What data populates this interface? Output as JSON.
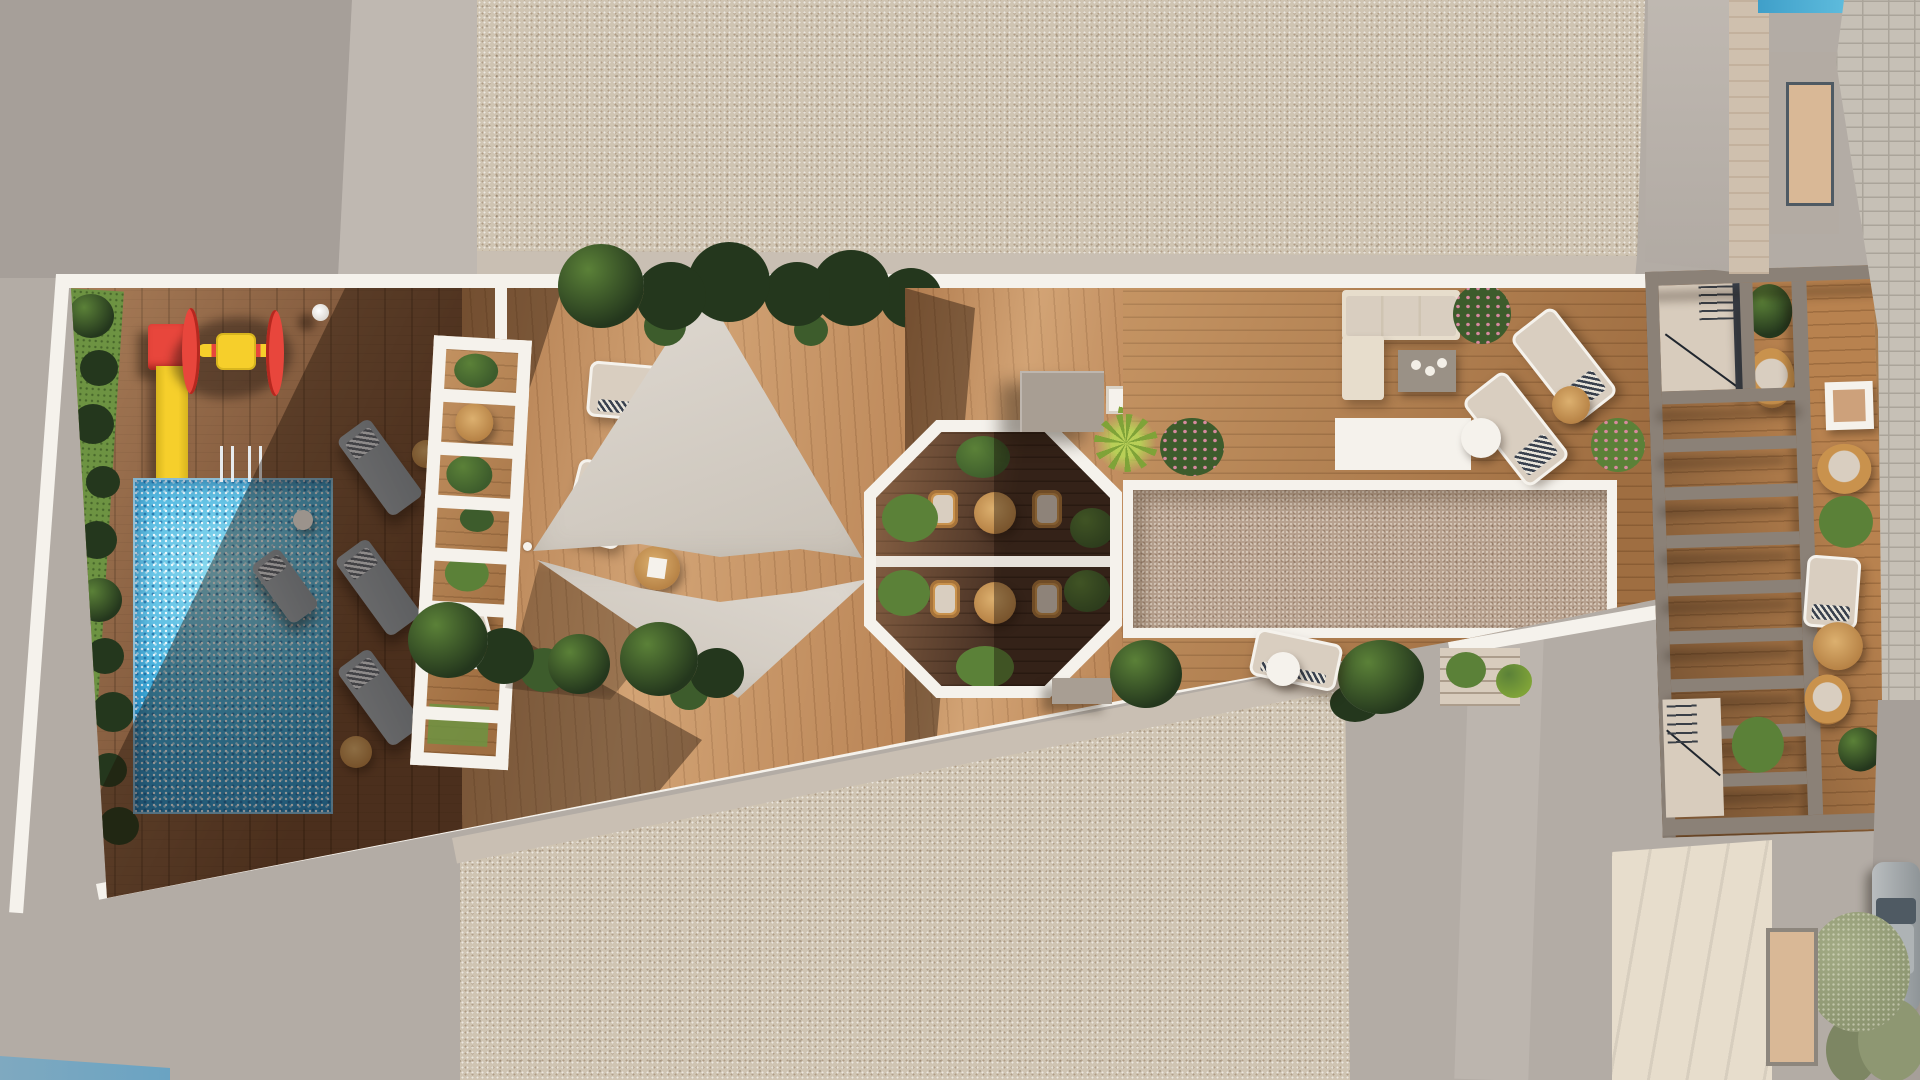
{
  "scene": {
    "type": "aerial architectural 3D rendering, top-down view",
    "description": "Rooftop terrace of a residential building seen from directly above, flanked by speckled concrete roof slabs, with a street and a parked car at the far right",
    "areas": {
      "pool": {
        "label": "Swimming pool with sparkling blue water and two chrome ladders"
      },
      "playground": {
        "label": "Children's playground: red tower with yellow slide into the pool and a red-yellow spinner toy"
      },
      "hedge": {
        "label": "Green hedge strip with dark shrubs along the left terrace edge"
      },
      "sun_deck_left": {
        "label": "Shaded timber pool deck with three grey sun loungers and side tables"
      },
      "white_canopy": {
        "label": "White slatted canopy walk (ladder-like pergola) with planters, a rattan table and a lounger beneath"
      },
      "sail_deck": {
        "label": "Sunlit timber deck with two triangular shade sails, two cream loungers and round serving tables"
      },
      "shade_sails": {
        "label": "Two light-grey triangular shade sails stretched between poles and tie points"
      },
      "planting_rows": {
        "label": "Rows of dark tropical foliage along the deck borders"
      },
      "octagon": {
        "label": "Octagonal sunken dining nook with four rattan chairs, two round tables and boxwood bushes"
      },
      "utility_block": {
        "label": "Taupe rooftop utility block beside the octagon with yucca planters"
      },
      "gravel_court": {
        "label": "Long white-framed gravel court in the centre-right deck"
      },
      "lounge_corner": {
        "label": "Lounge corner with cream L-shaped sofa, grey coffee table and two diagonal cream loungers with striped towels"
      },
      "pergola_right": {
        "label": "Grey slatted pergola with two stairwells, wicker chairs, framed table and planting"
      },
      "street": {
        "label": "Stone-paved sidewalk, olive street tree and partially visible parked car"
      },
      "neighbour_roofs": {
        "label": "Surrounding concrete and speckled rooftops, cream roof with awnings, sliver of a neighbouring pool"
      }
    },
    "furniture_counts": {
      "grey_loungers": 3,
      "cream_loungers": 6,
      "rattan_dining_chairs": 4,
      "wicker_chairs": 3,
      "round_tables": 9,
      "shade_sails": 2,
      "stairwells": 2
    }
  },
  "palette": {
    "bg": "#b3aca5",
    "bg-dark": "#a69f99",
    "bg-light": "#bfb8b1",
    "pave": "#cfc4b2",
    "tan": "#c9bfb3",
    "white": "#f5f2ec",
    "wood-light": "#c79160",
    "wood-mid": "#b8824f",
    "wood-deep": "#5f4130",
    "pool-mid": "#3aa9da",
    "pool-deep": "#1f86c2",
    "grass": "#6d9342",
    "leaf-dark": "#24371d",
    "leaf-mid": "#3d5c2c",
    "leaf-hi": "#5b8138",
    "leaf-olive": "#8e9772",
    "yucca-1": "#b8cf57",
    "yucca-2": "#7fa338",
    "red": "#e8463c",
    "yellow": "#f6cf2b",
    "pink": "#d989a0",
    "sail-1": "#e0dad2",
    "sail-2": "#c9c2b8",
    "gray-lounger": "#8b97a1",
    "beige": "#d9cec0",
    "cream": "#e7ddcc",
    "rattan": "#c9924d",
    "rattan-light": "#dcb06f",
    "taupe": "#a89e93",
    "gravel": "#b7a18f",
    "beam": "#8b8177",
    "stone": "#c6c0b6",
    "stone-line": "#aaa49a",
    "steel": "#9aa1a5",
    "glass": "#4f5a63",
    "stair": "#d8ccbd",
    "awning": "#d9b896",
    "water": "#6aa3c2"
  }
}
